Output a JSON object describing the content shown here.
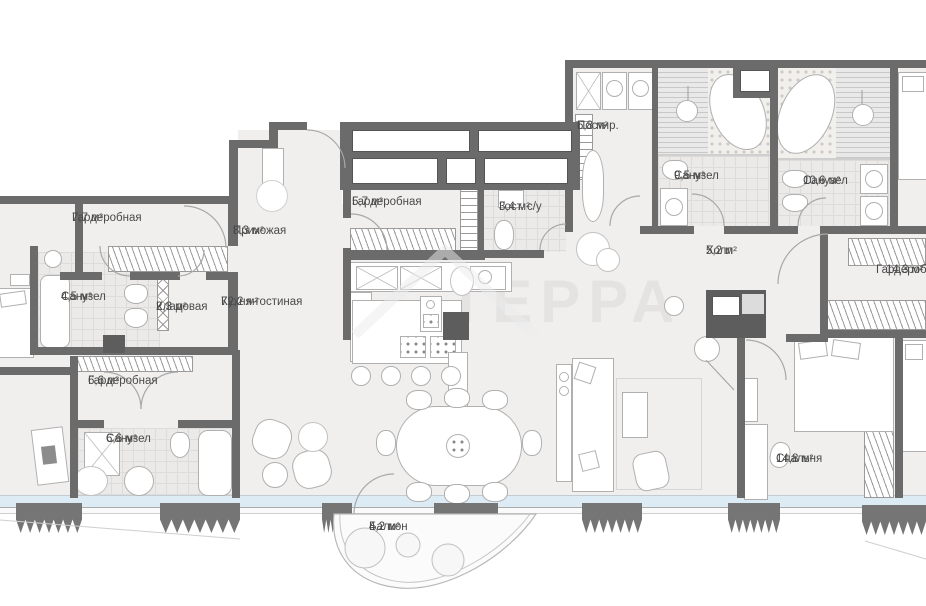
{
  "watermark": "ТЕРРА",
  "rooms": {
    "wardrobe_top": {
      "name": "Гардеробная",
      "area": "7,7 м²"
    },
    "entry": {
      "name": "Прихожая",
      "area": "8,3 м²"
    },
    "wardrobe_mid": {
      "name": "Гардеробная",
      "area": "5,7 м²"
    },
    "guest_wc": {
      "name": "Гост. с/у",
      "area": "3,4 м²"
    },
    "laundry": {
      "name": "Постир.",
      "area": "6,8 м²"
    },
    "bath_95": {
      "name": "Санузел",
      "area": "9,5 м²"
    },
    "bath_106": {
      "name": "Санузел",
      "area": "10,6 м²"
    },
    "hall": {
      "name": "Холл",
      "area": "5,2 м²"
    },
    "wardrobe_right": {
      "name": "Гардеробная",
      "area": "14,3 м²"
    },
    "bath_45": {
      "name": "Санузел",
      "area": "4,5 м²"
    },
    "storage": {
      "name": "Кладовая",
      "area": "2,3 м²"
    },
    "kitchen_living": {
      "name": "Кухня-гостиная",
      "area": "72,2 м²"
    },
    "wardrobe_low": {
      "name": "Гардеробная",
      "area": "6,6 м²"
    },
    "bath_66": {
      "name": "Санузел",
      "area": "6,6 м²"
    },
    "bedroom": {
      "name": "Спальня",
      "area": "14,8 м²"
    },
    "balcony": {
      "name": "Балкон",
      "area": "4,2 м²"
    }
  },
  "colors": {
    "wall": "#6b6b6b",
    "floor": "#f0efee",
    "window_glass": "#dcebf4",
    "label_text": "#4a4a4a"
  }
}
